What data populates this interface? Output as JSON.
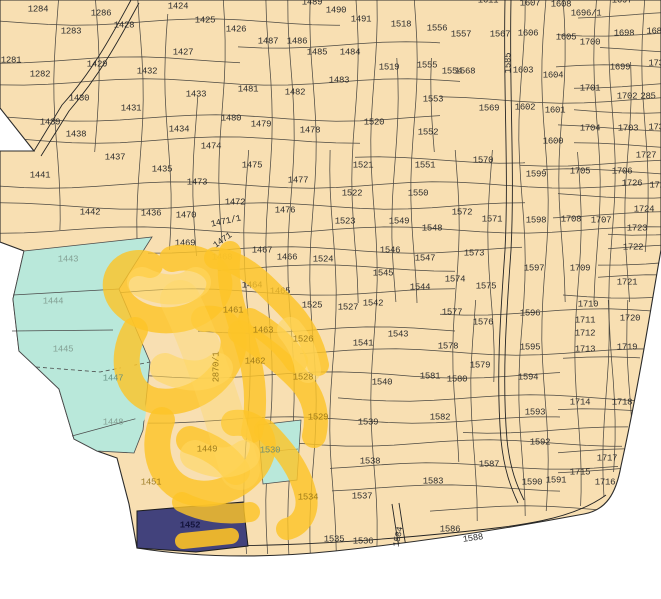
{
  "map": {
    "colors": {
      "background": "#ffffff",
      "land": "#f8dfb2",
      "boundary_line": "#2b2b2b",
      "water_parcels": "#b9e8da",
      "selected_parcel": "#42427c",
      "highlight": "#fdc426",
      "highlight_light": "#ffd75f",
      "label": "#2e2e2e",
      "covered_label": "#8f6e12",
      "cyan_label": "#84a094"
    },
    "labels": [
      [
        "1284",
        38,
        10
      ],
      [
        "1286",
        101,
        14
      ],
      [
        "1283",
        71,
        32
      ],
      [
        "1281",
        11,
        61
      ],
      [
        "1282",
        40,
        75
      ],
      [
        "1424",
        178,
        7
      ],
      [
        "1425",
        205,
        21
      ],
      [
        "1426",
        236,
        30
      ],
      [
        "1428",
        124,
        26
      ],
      [
        "1427",
        183,
        53
      ],
      [
        "1429",
        97,
        65
      ],
      [
        "1432",
        147,
        72
      ],
      [
        "1430",
        79,
        99
      ],
      [
        "1433",
        196,
        95
      ],
      [
        "1431",
        131,
        109
      ],
      [
        "1439",
        50,
        123
      ],
      [
        "1438",
        76,
        135
      ],
      [
        "1434",
        179,
        130
      ],
      [
        "1474",
        211,
        147
      ],
      [
        "1437",
        115,
        158
      ],
      [
        "1441",
        40,
        176
      ],
      [
        "1435",
        162,
        170
      ],
      [
        "1473",
        197,
        183
      ],
      [
        "1442",
        90,
        213
      ],
      [
        "1436",
        151,
        214
      ],
      [
        "1470",
        186,
        216
      ],
      [
        "1469",
        185,
        244
      ],
      [
        "1468",
        222,
        258
      ],
      [
        "1487",
        268,
        42
      ],
      [
        "1486",
        297,
        42
      ],
      [
        "1489",
        312,
        3
      ],
      [
        "1490",
        336,
        11
      ],
      [
        "1491",
        361,
        20
      ],
      [
        "1485",
        317,
        53
      ],
      [
        "1484",
        350,
        53
      ],
      [
        "1483",
        339,
        81
      ],
      [
        "1481",
        248,
        90
      ],
      [
        "1482",
        295,
        93
      ],
      [
        "1480",
        231,
        119
      ],
      [
        "1479",
        261,
        125
      ],
      [
        "1478",
        310,
        131
      ],
      [
        "1475",
        252,
        166
      ],
      [
        "1477",
        298,
        181
      ],
      [
        "1472",
        235,
        203
      ],
      [
        "1476",
        285,
        211
      ],
      [
        "1467",
        262,
        251
      ],
      [
        "1466",
        287,
        258
      ],
      [
        "1464",
        252,
        286
      ],
      [
        "1465",
        280,
        292
      ],
      [
        "1518",
        401,
        25
      ],
      [
        "1519",
        389,
        68
      ],
      [
        "1520",
        374,
        123
      ],
      [
        "1521",
        363,
        166
      ],
      [
        "1522",
        352,
        194
      ],
      [
        "1523",
        345,
        222
      ],
      [
        "1524",
        323,
        260
      ],
      [
        "1525",
        312,
        306
      ],
      [
        "1527",
        348,
        308
      ],
      [
        "1556",
        437,
        29
      ],
      [
        "1557",
        461,
        35
      ],
      [
        "1555",
        427,
        66
      ],
      [
        "1554",
        452,
        72
      ],
      [
        "1553",
        433,
        100
      ],
      [
        "1552",
        428,
        133
      ],
      [
        "1551",
        425,
        166
      ],
      [
        "1550",
        418,
        194
      ],
      [
        "1549",
        399,
        222
      ],
      [
        "1548",
        432,
        229
      ],
      [
        "1546",
        390,
        251
      ],
      [
        "1547",
        425,
        259
      ],
      [
        "1545",
        383,
        274
      ],
      [
        "1544",
        420,
        288
      ],
      [
        "1542",
        373,
        304
      ],
      [
        "1543",
        398,
        335
      ],
      [
        "1541",
        363,
        344
      ],
      [
        "1540",
        382,
        383
      ],
      [
        "1539",
        368,
        423
      ],
      [
        "1538",
        370,
        462
      ],
      [
        "1537",
        362,
        497
      ],
      [
        "1535",
        334,
        540
      ],
      [
        "1536",
        363,
        542
      ],
      [
        "1567",
        500,
        35
      ],
      [
        "1568",
        465,
        72
      ],
      [
        "1569",
        489,
        109
      ],
      [
        "1570",
        483,
        161
      ],
      [
        "1572",
        462,
        213
      ],
      [
        "1571",
        492,
        220
      ],
      [
        "1573",
        474,
        254
      ],
      [
        "1574",
        455,
        280
      ],
      [
        "1575",
        486,
        287
      ],
      [
        "1577",
        452,
        313
      ],
      [
        "1576",
        483,
        323
      ],
      [
        "1578",
        448,
        347
      ],
      [
        "1579",
        480,
        366
      ],
      [
        "1581",
        430,
        377
      ],
      [
        "1580",
        457,
        380
      ],
      [
        "1582",
        440,
        418
      ],
      [
        "1583",
        433,
        482
      ],
      [
        "1586",
        450,
        530
      ],
      [
        "1587",
        489,
        465
      ],
      [
        "1611",
        488,
        1
      ],
      [
        "1607",
        530,
        4
      ],
      [
        "1608",
        561,
        5
      ],
      [
        "1697",
        622,
        1
      ],
      [
        "1696/1",
        586,
        14
      ],
      [
        "1606",
        528,
        34
      ],
      [
        "1605",
        566,
        38
      ],
      [
        "1700",
        590,
        43
      ],
      [
        "1698",
        624,
        34
      ],
      [
        "168",
        654,
        32
      ],
      [
        "1603",
        523,
        71
      ],
      [
        "1604",
        553,
        76
      ],
      [
        "1699",
        620,
        68
      ],
      [
        "173",
        656,
        64
      ],
      [
        "1701",
        590,
        89
      ],
      [
        "1602",
        525,
        108
      ],
      [
        "1601",
        555,
        111
      ],
      [
        "1702",
        627,
        97
      ],
      [
        "285",
        648,
        97
      ],
      [
        "1600",
        553,
        142
      ],
      [
        "1704",
        590,
        129
      ],
      [
        "1703",
        628,
        129
      ],
      [
        "173",
        656,
        128
      ],
      [
        "1599",
        536,
        175
      ],
      [
        "1705",
        580,
        172
      ],
      [
        "1706",
        622,
        172
      ],
      [
        "1727",
        646,
        156
      ],
      [
        "1726",
        632,
        184
      ],
      [
        "172",
        657,
        186
      ],
      [
        "1598",
        536,
        221
      ],
      [
        "1708",
        571,
        220
      ],
      [
        "1707",
        601,
        221
      ],
      [
        "1724",
        644,
        210
      ],
      [
        "1723",
        637,
        229
      ],
      [
        "1722",
        633,
        248
      ],
      [
        "1597",
        534,
        269
      ],
      [
        "1709",
        580,
        269
      ],
      [
        "1721",
        627,
        283
      ],
      [
        "1596",
        530,
        314
      ],
      [
        "1710",
        588,
        305
      ],
      [
        "1711",
        585,
        321
      ],
      [
        "1720",
        630,
        319
      ],
      [
        "1712",
        585,
        334
      ],
      [
        "1595",
        530,
        348
      ],
      [
        "1713",
        585,
        350
      ],
      [
        "1719",
        627,
        348
      ],
      [
        "1594",
        528,
        378
      ],
      [
        "1714",
        580,
        403
      ],
      [
        "1718",
        622,
        403
      ],
      [
        "1593",
        535,
        413
      ],
      [
        "1592",
        540,
        443
      ],
      [
        "1590",
        532,
        483
      ],
      [
        "1591",
        556,
        481
      ],
      [
        "1715",
        580,
        473
      ],
      [
        "1717",
        607,
        459
      ],
      [
        "1716",
        605,
        483
      ]
    ],
    "rotated_labels": [
      [
        "1471/1",
        226,
        222,
        -12
      ],
      [
        "1471",
        223,
        241,
        -35
      ],
      [
        "1585",
        509,
        63,
        -90
      ],
      [
        "1584",
        399,
        537,
        -78
      ],
      [
        "1588",
        473,
        539,
        -8
      ]
    ],
    "covered_labels": [
      [
        "1461",
        233,
        311
      ],
      [
        "1463",
        263,
        331
      ],
      [
        "1526",
        303,
        340
      ],
      [
        "1462",
        255,
        362
      ],
      [
        "1528",
        303,
        378
      ],
      [
        "1529",
        318,
        418
      ],
      [
        "1449",
        207,
        450
      ],
      [
        "1451",
        151,
        483
      ],
      [
        "1534",
        308,
        498
      ]
    ],
    "covered_rotated_labels": [
      [
        "2870/1",
        217,
        367,
        -90
      ]
    ],
    "cyan_parcel_labels": [
      [
        "1443",
        68,
        260
      ],
      [
        "1444",
        53,
        302
      ],
      [
        "1445",
        63,
        350
      ],
      [
        "1448",
        113,
        423
      ]
    ],
    "cyan_covered_labels": [
      [
        "1447",
        113,
        379
      ],
      [
        "1530",
        270,
        451
      ]
    ],
    "selected_parcel_label": [
      "1452",
      190,
      526
    ]
  }
}
